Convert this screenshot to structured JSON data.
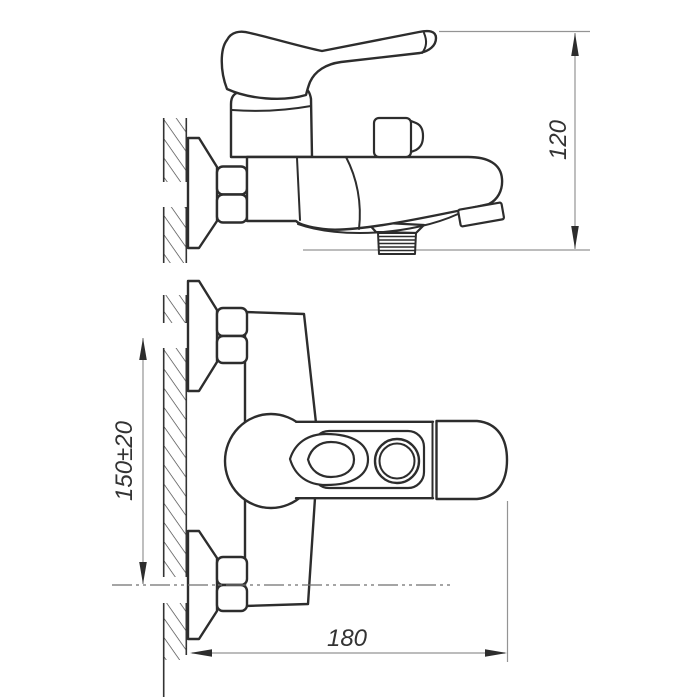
{
  "drawing": {
    "type": "technical-drawing",
    "subject": "wall-mounted bath mixer faucet shown in side view and plan view with dimensions",
    "dimensions": {
      "height": "120",
      "mounting_spacing": "150±20",
      "length": "180"
    },
    "colors": {
      "object_line": "#2d2d2d",
      "dimension_line": "#949494",
      "background": "#ffffff"
    }
  }
}
